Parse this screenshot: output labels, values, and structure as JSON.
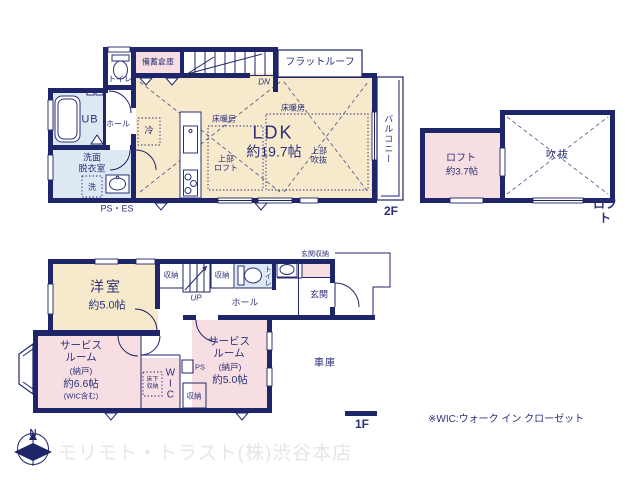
{
  "colors": {
    "wall": "#1f2569",
    "text": "#2b3178",
    "room_beige": "#f6e9cc",
    "room_pink": "#f7dee3",
    "room_blue": "#dde8f3",
    "watermark": "#e6e6e6"
  },
  "plan2f": {
    "toilet": "トイレ",
    "stock_storage": "備蓄倉庫",
    "flat_roof": "フラットルーフ",
    "dn": "DN",
    "ub": "UB",
    "hall": "ホール",
    "washroom": "洗面\n脱衣室",
    "washer": "洗",
    "ps_es": "PS・ES",
    "fridge": "冷",
    "floor_heating": "床暖房",
    "ldk": "LDK",
    "ldk_size": "約19.7帖",
    "upper_loft": "上部\nロフト",
    "upper_void": "上部\n吹抜",
    "balcony": "バルコニー",
    "floor_label": "2F"
  },
  "loft": {
    "name": "ロフト",
    "size": "約3.7帖",
    "void": "吹抜",
    "floor_label": "ロフト"
  },
  "plan1f": {
    "western_room": "洋室",
    "western_room_size": "約5.0帖",
    "closet": "収納",
    "up": "UP",
    "toilet": "トイレ",
    "hall": "ホール",
    "entrance_storage": "玄関収納",
    "entrance": "玄関",
    "service1_name": "サービス\nルーム",
    "service1_type": "(納戸)",
    "service1_size": "約6.6帖",
    "service1_note": "(WIC含む)",
    "service2_name": "サービス\nルーム",
    "service2_type": "(納戸)",
    "service2_size": "約5.0帖",
    "wic": "WIC",
    "underfloor_storage": "床下\n収納",
    "ps": "PS",
    "garage": "車庫",
    "floor_label": "1F",
    "north": "N"
  },
  "footer": {
    "wic_note": "※WIC:ウォーク イン クローゼット",
    "watermark": "モリモト・トラスト(株)渋谷本店"
  }
}
